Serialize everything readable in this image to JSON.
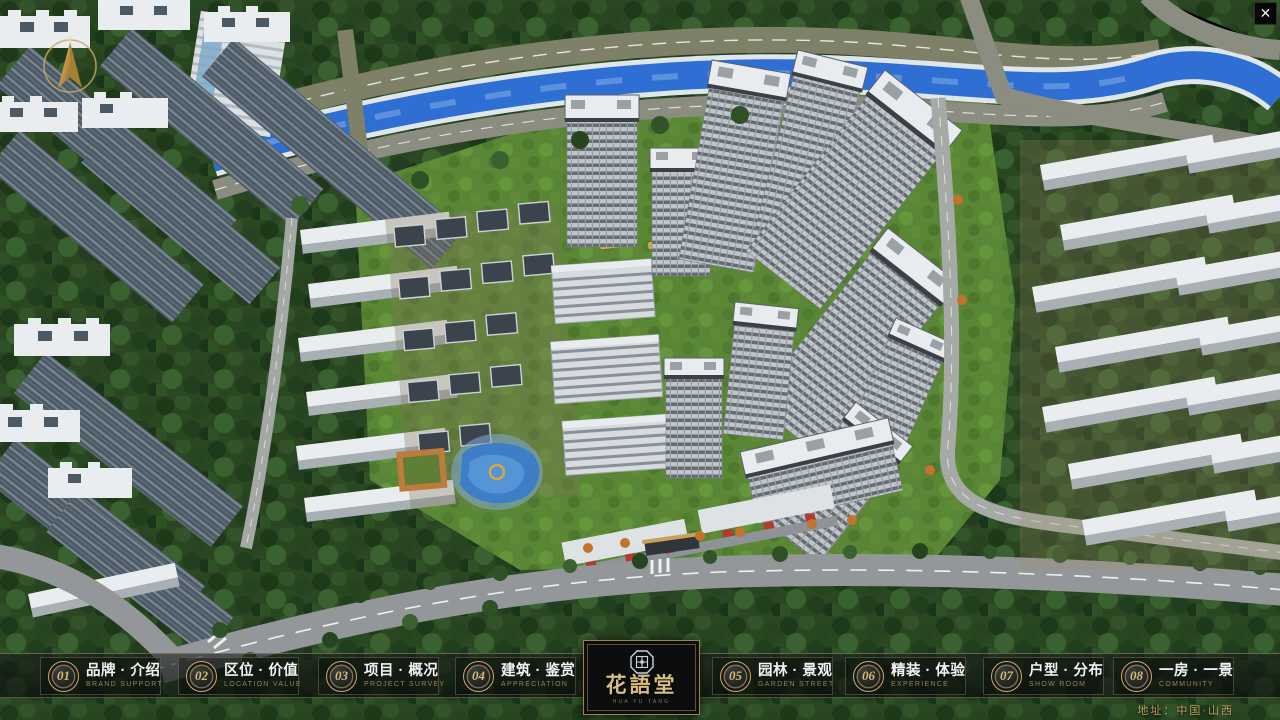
{
  "window": {
    "close_glyph": "✕"
  },
  "nav": {
    "items": [
      {
        "num": "01",
        "zh": "品牌 · 介绍",
        "en": "BRAND SUPPORT"
      },
      {
        "num": "02",
        "zh": "区位 · 价值",
        "en": "LOCATION VALUE"
      },
      {
        "num": "03",
        "zh": "项目 · 概况",
        "en": "PROJECT SURVEY"
      },
      {
        "num": "04",
        "zh": "建筑 · 鉴赏",
        "en": "APPRECIATION"
      },
      {
        "num": "05",
        "zh": "园林 · 景观",
        "en": "GARDEN STREET"
      },
      {
        "num": "06",
        "zh": "精装 · 体验",
        "en": "EXPERIENCE"
      },
      {
        "num": "07",
        "zh": "户型 · 分布",
        "en": "SHOW ROOM"
      },
      {
        "num": "08",
        "zh": "一房 · 一景",
        "en": "COMMUNITY"
      }
    ]
  },
  "logo": {
    "title": "花語堂",
    "subtitle": "HUA YU TANG"
  },
  "footer": {
    "address": "地址：中国·山西"
  },
  "colors": {
    "gold": "#C9A86A",
    "gold_dim": "#9B8350",
    "logo_gold": "#D8BC82",
    "address_gold": "#BD9E62",
    "panel_bg": "rgba(8,10,10,0.38)",
    "river_blue": "#2F6FD3",
    "lawn_green": "#5D8A36"
  }
}
